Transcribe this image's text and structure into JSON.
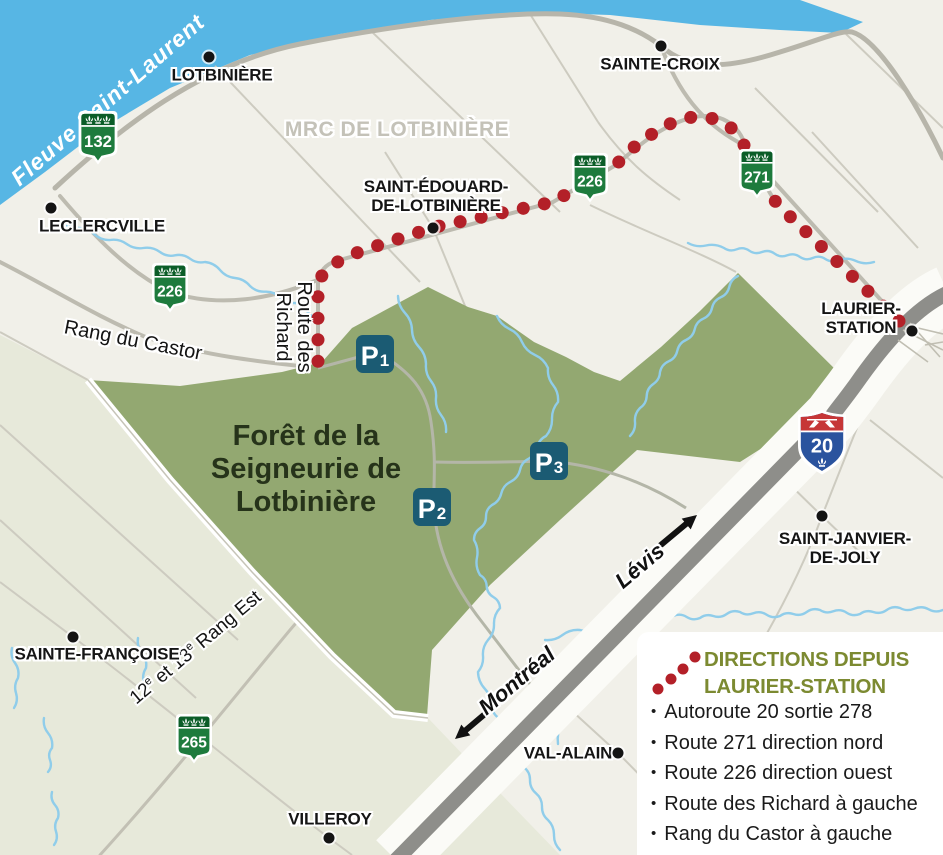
{
  "region_label": "MRC DE LOTBINIÈRE",
  "river_label": "Fleuve Saint-Laurent",
  "forest": {
    "lines": [
      "Forêt de la",
      "Seigneurie de",
      "Lotbinière"
    ]
  },
  "towns": [
    {
      "id": "lotbiniere",
      "lines": [
        "LOTBINIÈRE"
      ]
    },
    {
      "id": "sainte-croix",
      "lines": [
        "SAINTE-CROIX"
      ]
    },
    {
      "id": "leclercville",
      "lines": [
        "LECLERCVILLE"
      ]
    },
    {
      "id": "saint-edouard",
      "lines": [
        "SAINT-ÉDOUARD-",
        "DE-LOTBINIÈRE"
      ]
    },
    {
      "id": "laurier-station",
      "lines": [
        "LAURIER-",
        "STATION"
      ]
    },
    {
      "id": "saint-janvier",
      "lines": [
        "SAINT-JANVIER-",
        "DE-JOLY"
      ]
    },
    {
      "id": "sainte-francoise",
      "lines": [
        "SAINTE-FRANÇOISE"
      ]
    },
    {
      "id": "val-alain",
      "lines": [
        "VAL-ALAIN"
      ]
    },
    {
      "id": "villeroy",
      "lines": [
        "VILLEROY"
      ]
    }
  ],
  "road_labels": {
    "rang_du_castor": "Rang du Castor",
    "route_des_richard": [
      "Route des",
      "Richard"
    ],
    "rang_est": {
      "text": "12e et 13e Rang Est",
      "p1": "12",
      "s1": "e",
      "p2": " et 13",
      "s2": "e",
      "p3": " Rang Est"
    }
  },
  "direction_labels": {
    "levis": "Lévis",
    "montreal": "Montréal"
  },
  "shields": {
    "provincial": [
      {
        "id": "s132",
        "number": "132"
      },
      {
        "id": "s226w",
        "number": "226"
      },
      {
        "id": "s226m",
        "number": "226"
      },
      {
        "id": "s271",
        "number": "271"
      },
      {
        "id": "s265",
        "number": "265"
      }
    ],
    "autoroute": {
      "number": "20"
    }
  },
  "parkings": [
    {
      "id": "p1",
      "letter": "P",
      "index": "1"
    },
    {
      "id": "p2",
      "letter": "P",
      "index": "2"
    },
    {
      "id": "p3",
      "letter": "P",
      "index": "3"
    }
  ],
  "legend": {
    "title_lines": [
      "DIRECTIONS DEPUIS",
      "LAURIER-STATION"
    ],
    "items": [
      "Autoroute 20 sortie 278",
      "Route 271 direction nord",
      "Route 226 direction ouest",
      "Route des Richard à gauche",
      "Rang du Castor à gauche"
    ]
  },
  "colors": {
    "land": "#f1f0e9",
    "sage": "#e7e9da",
    "river": "#57b6e4",
    "stream": "#90cdea",
    "forest": "#93a871",
    "forest_text": "#26331a",
    "highway_gray": "#8e8e8a",
    "highway_corridor": "#fbfbf7",
    "route_dots_red": "#b32028",
    "town_dot": "#141414",
    "shield_green": "#1e7b3d",
    "shield_band_green": "#0b5d28",
    "autoroute_blue": "#2a539e",
    "autoroute_red": "#c63637",
    "parking_teal": "#1b5b73",
    "legend_title_olive": "#7c8a31",
    "region_label_gray": "#c4c2b8"
  }
}
